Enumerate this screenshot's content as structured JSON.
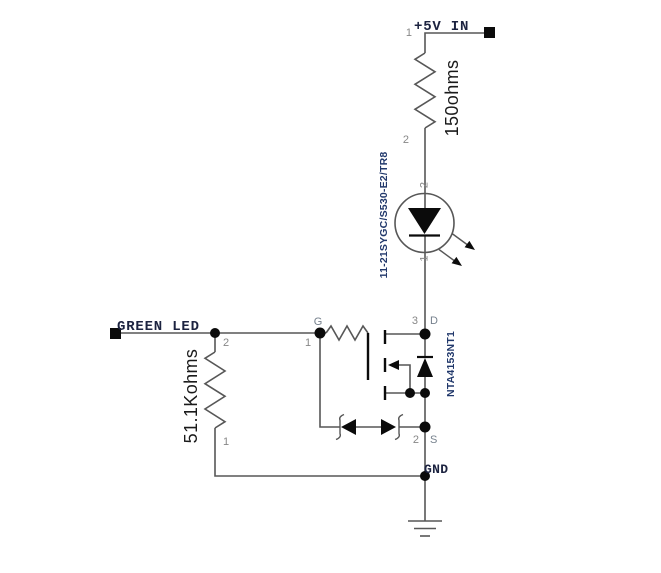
{
  "nets": {
    "vcc_label": "+5V IN",
    "input_label": "GREEN LED",
    "gnd_label": "GND"
  },
  "components": {
    "r1": {
      "value": "150ohms",
      "pin_top_num": "1",
      "pin_bottom_num": "2"
    },
    "d1": {
      "part_number": "11-21SYGC/S530-E2/TR8",
      "pin_top_num": "2",
      "pin_bottom_num": "1"
    },
    "q1": {
      "part_number": "NTA4153NT1",
      "gate_num": "1",
      "gate_name": "G",
      "drain_num": "3",
      "drain_name": "D",
      "source_num": "2",
      "source_name": "S"
    },
    "r2": {
      "value": "51.1Kohms",
      "pin_top_num": "2",
      "pin_bottom_num": "1"
    }
  },
  "colors": {
    "wire": "#575757",
    "solid": "#0b0b0b",
    "pin_number": "#878787",
    "pin_name": "#76818d",
    "net_label": "#1c2340",
    "part_number": "#21386b",
    "value_label": "#1a1a1a"
  }
}
